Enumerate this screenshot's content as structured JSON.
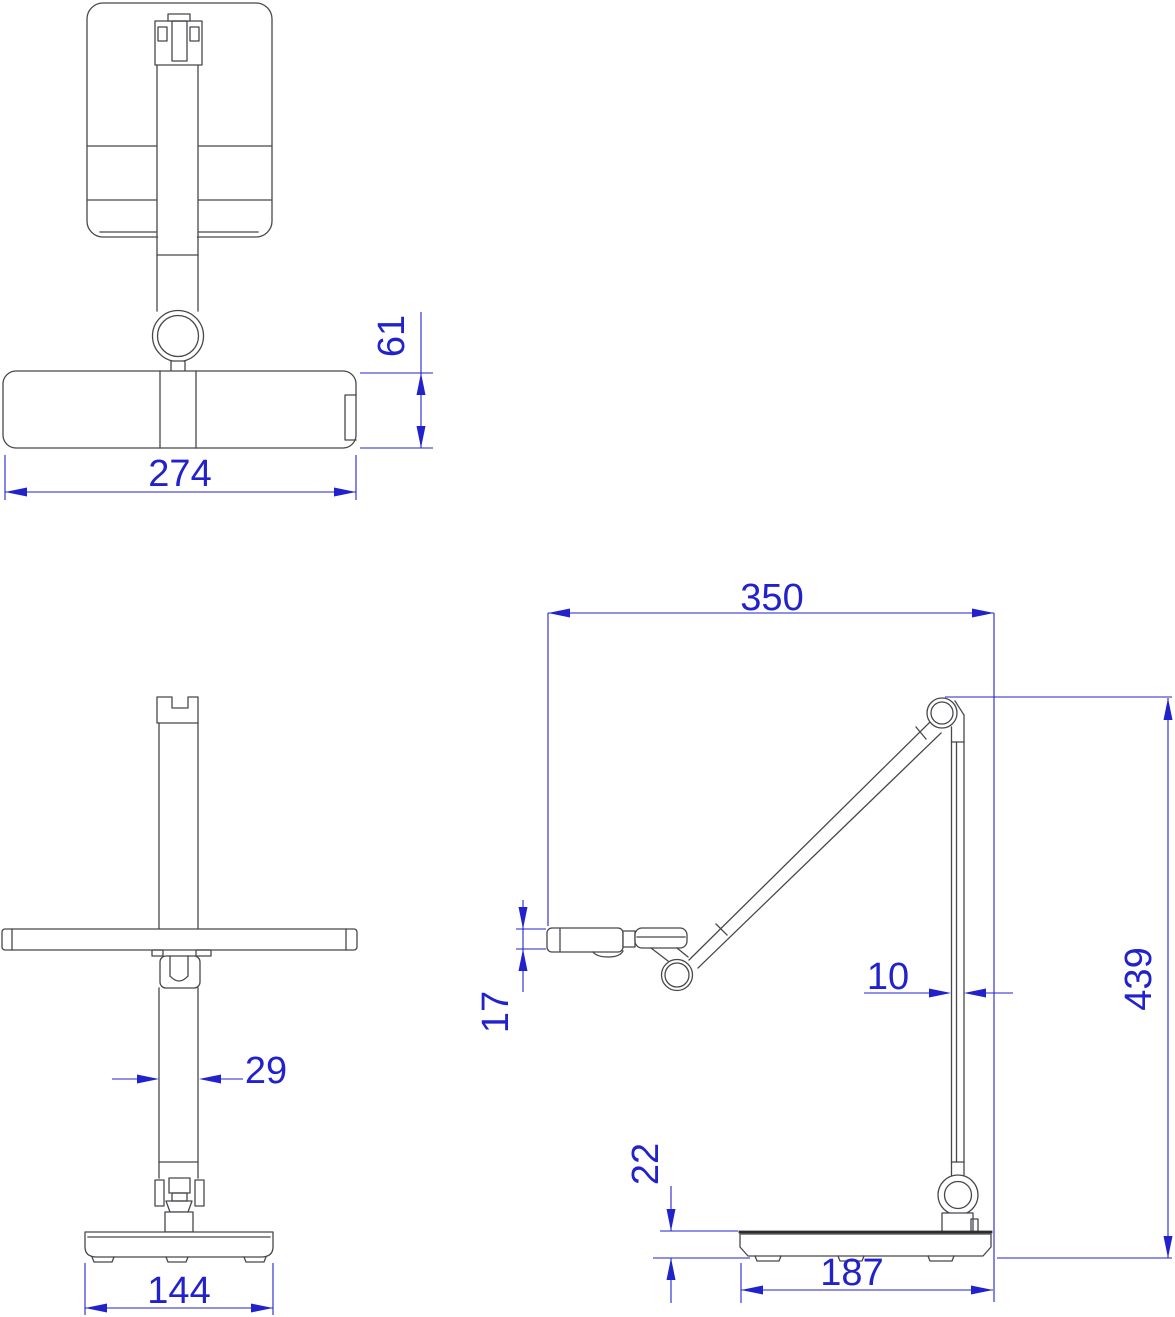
{
  "dimensions": {
    "top_view": {
      "width": "274",
      "head_depth": "61"
    },
    "front_view": {
      "pole_width": "29",
      "base_width": "144"
    },
    "side_view": {
      "arm_reach": "350",
      "head_thickness": "17",
      "pole_thickness": "10",
      "total_height": "439",
      "base_height": "22",
      "base_depth": "187"
    }
  },
  "colors": {
    "dimension": "#2222cc",
    "outline": "#47484c",
    "background": "#ffffff"
  }
}
